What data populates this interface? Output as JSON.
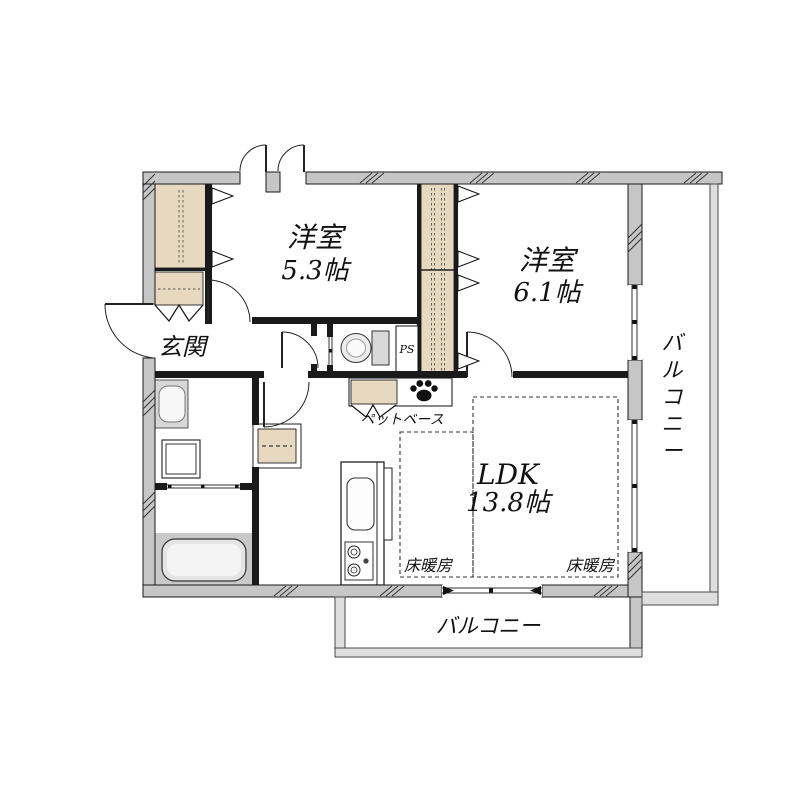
{
  "floorplan": {
    "rooms": {
      "bedroom1": {
        "name": "洋室",
        "size": "5.3帖"
      },
      "bedroom2": {
        "name": "洋室",
        "size": "6.1帖"
      },
      "ldk": {
        "name": "LDK",
        "size": "13.8帖"
      },
      "entrance": {
        "label": "玄関"
      }
    },
    "balconies": {
      "right": {
        "label": "バルコニー"
      },
      "bottom": {
        "label": "バルコニー"
      }
    },
    "annotations": {
      "floor_heating_left": "床暖房",
      "floor_heating_right": "床暖房",
      "pet_base": "ペットベース",
      "pipe_space": "PS"
    },
    "icons": {
      "paw": "paw-print-icon"
    },
    "colors": {
      "exterior_wall": "#c6c6c6",
      "closet_fill": "#e7d9bf",
      "balcony_rail": "#dedede",
      "line": "#1a1a1a",
      "floor": "#ffffff"
    }
  }
}
